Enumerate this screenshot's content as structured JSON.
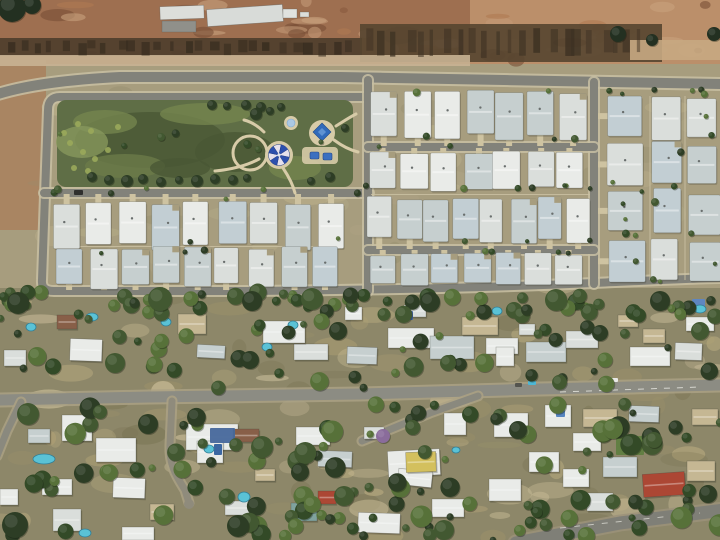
{
  "meta": {
    "label": "Aerial photograph of a new suburban housing estate with a park and playground beside cleared construction land, bordering an older tree-covered suburb"
  },
  "palette": {
    "dirt": "#a06f4e",
    "dirtR": "#bd8f68",
    "groundNew": "#a89d7c",
    "groundOld": "#8d8767",
    "road": "#82827a",
    "roadOld": "#8c8c83",
    "curbNew": "#c8bfa2",
    "curbOld": "#aba183",
    "drive": "#cfc39f",
    "path": "#d8cba6",
    "parkBase": "#5f6e44",
    "pd": "#4a5733",
    "pl": "#74844c",
    "shrub": "#9aa957",
    "rw": "#e9ebe8",
    "rl": "#dadedb",
    "rg": "#c6cfcf",
    "rb": "#c2ced3",
    "rt": "#c6b791",
    "rbr": "#8a5f46",
    "rr": "#b04632",
    "ry": "#d4c059",
    "rteal": "#7fa39e",
    "pool": "#56c3d8",
    "poolEdge": "#2e7f98",
    "umbBlue": "#2b50b2",
    "umbWhite": "#e6e1ec",
    "canopy": "#2e6abf",
    "canopyIn": "#5d92d6",
    "dome": "#aac8e6"
  },
  "bg": [
    [
      0,
      0,
      720,
      74,
      "dirt"
    ],
    [
      470,
      0,
      250,
      64,
      "dirtR"
    ],
    [
      0,
      64,
      720,
      236,
      "groundNew"
    ],
    [
      0,
      60,
      46,
      170,
      "#ab8560"
    ],
    [
      0,
      288,
      720,
      252,
      "groundOld"
    ]
  ],
  "construction": {
    "patches": {
      "seed": 7,
      "count": 55,
      "x0": 0,
      "x1": 720,
      "y0": 0,
      "y1": 60,
      "colors": [
        "#8a5a3c",
        "#c49a74",
        "#b07a50",
        "#7a4f34",
        "#c9a27c"
      ]
    },
    "rects": [
      [
        0,
        38,
        362,
        18,
        "#4e3d2b"
      ],
      [
        360,
        24,
        302,
        38,
        "#57452f"
      ],
      [
        0,
        55,
        470,
        11,
        "#c9b291"
      ],
      [
        630,
        40,
        90,
        20,
        "#c8a87f"
      ]
    ],
    "ticks": [
      {
        "seed": 11,
        "count": 26,
        "x0": 4,
        "x1": 356,
        "y": 40,
        "h": 14,
        "c": "#382c1e"
      },
      {
        "seed": 12,
        "count": 22,
        "x0": 364,
        "x1": 648,
        "y": 28,
        "h": 28,
        "c": "#3e3122"
      }
    ],
    "sheds": [
      [
        160,
        6,
        44,
        13,
        -2,
        "#dcdeda"
      ],
      [
        207,
        7,
        76,
        17,
        -4,
        "#d8dbd8"
      ],
      [
        283,
        9,
        14,
        9,
        0,
        "#e0e2df"
      ],
      [
        162,
        21,
        34,
        11,
        0,
        "#90908a"
      ],
      [
        300,
        12,
        9,
        5,
        0,
        "#dcdeda"
      ]
    ],
    "trees": [
      [
        12,
        8,
        14
      ],
      [
        32,
        5,
        9
      ],
      [
        618,
        34,
        8
      ],
      [
        652,
        40,
        6
      ],
      [
        714,
        34,
        7
      ]
    ]
  },
  "groundBands": [
    {
      "seed": 41,
      "x0": 0,
      "x1": 720,
      "y0": 300,
      "y1": 538,
      "count": 70,
      "colors": [
        "#b3a274",
        "#c0b080",
        "#7a7451",
        "#9c9168"
      ],
      "op": 0.55
    },
    {
      "seed": 42,
      "x0": 46,
      "x1": 716,
      "y0": 90,
      "y1": 288,
      "count": 45,
      "colors": [
        "#b3a986",
        "#97906e",
        "#c2b68d"
      ],
      "op": 0.5
    },
    {
      "seed": 43,
      "x0": 10,
      "x1": 710,
      "y0": 305,
      "y1": 530,
      "count": 26,
      "colors": [
        "#c6b893",
        "#cfc098"
      ],
      "op": 0.65
    }
  ],
  "roadsOld": [
    {
      "d": "M0,400 L150,397 L360,394 L540,389 L720,385",
      "w": 11,
      "c": "roadOld",
      "curb": "curbOld"
    },
    {
      "d": "M478,396 L430,413 L362,441",
      "w": 7,
      "c": "#8a897d",
      "curb": "curbOld"
    },
    {
      "d": "M172,401 L170,445 C169,466 177,477 185,490 L189,503",
      "w": 7,
      "c": "#8f8b7b",
      "curb": "curbOld"
    },
    {
      "d": "M21,402 L7,431 L-3,456",
      "w": 7,
      "c": "#8a897d",
      "curb": "curbOld"
    },
    {
      "d": "M516,543 L620,523 L724,510",
      "w": 13,
      "c": "#7f7f77",
      "curb": "#9b9279"
    }
  ],
  "roadsNew": [
    {
      "d": "M-2,94 Q40,81 120,77 L340,77 Q520,80 720,84",
      "w": 10,
      "c": "road",
      "curb": "curbNew"
    },
    {
      "d": "M368,97 L60,97 Q48,97 48,110 L42,280 Q41,291 54,291 L250,291 C380,290 500,287 594,283 C660,280 700,278 722,278",
      "w": 8,
      "c": "road",
      "curb": "curbNew"
    },
    {
      "d": "M44,193 L369,193",
      "w": 8,
      "c": "road",
      "curb": "curbNew"
    },
    {
      "d": "M368,80 L368,291",
      "w": 8,
      "c": "road",
      "curb": "curbNew"
    },
    {
      "d": "M594,82 L594,284",
      "w": 8,
      "c": "road",
      "curb": "curbNew"
    },
    {
      "d": "M368,147 L594,147",
      "w": 8,
      "c": "road",
      "curb": "curbNew"
    },
    {
      "d": "M368,250 L594,250",
      "w": 8,
      "c": "road",
      "curb": "curbNew"
    }
  ],
  "dashes": [
    {
      "d": "M560,392 L700,387",
      "c": "#e8e8e2",
      "w": 1,
      "da": "6 7"
    },
    {
      "d": "M560,528 L700,513",
      "c": "#d8d8d0",
      "w": 1,
      "da": "6 8"
    }
  ],
  "roadDots": [
    [
      189,
      504,
      5,
      "#8f8b7b"
    ]
  ],
  "fences": [
    {
      "d": "M54,246.5 L342,246.5"
    },
    {
      "d": "M371,194.5 L590,194.5"
    },
    {
      "d": "M650,96 L650,280"
    },
    {
      "d": "M685,96 L685,280"
    }
  ],
  "park": {
    "base": [
      57,
      100,
      296,
      87
    ],
    "patches": [
      [
        150,
        140,
        75,
        28,
        "pd"
      ],
      [
        235,
        152,
        40,
        20,
        "pd"
      ],
      [
        105,
        122,
        32,
        12,
        "pl"
      ],
      [
        205,
        114,
        45,
        11,
        "pl"
      ],
      [
        295,
        168,
        26,
        12,
        "pl"
      ],
      [
        125,
        166,
        40,
        12,
        "#6b7a47"
      ],
      [
        82,
        142,
        26,
        16,
        "#87975a"
      ],
      [
        180,
        168,
        30,
        10,
        "pd"
      ]
    ],
    "shrubs": [
      [
        78,
        124
      ],
      [
        91,
        131
      ],
      [
        70,
        143
      ],
      [
        83,
        152
      ],
      [
        95,
        159
      ],
      [
        74,
        168
      ],
      [
        88,
        171
      ],
      [
        118,
        127
      ],
      [
        108,
        150
      ],
      [
        64,
        133
      ]
    ],
    "trees": [
      [
        212,
        105,
        5
      ],
      [
        227,
        106,
        4
      ],
      [
        246,
        105,
        5
      ],
      [
        261,
        107,
        5
      ],
      [
        256,
        114,
        6
      ],
      [
        270,
        111,
        4
      ],
      [
        281,
        107,
        4
      ],
      [
        92,
        177,
        5
      ],
      [
        109,
        180,
        5
      ],
      [
        127,
        181,
        6
      ],
      [
        143,
        179,
        5
      ],
      [
        161,
        182,
        5
      ],
      [
        179,
        180,
        4
      ],
      [
        197,
        181,
        6
      ],
      [
        215,
        179,
        5
      ],
      [
        233,
        180,
        5
      ],
      [
        247,
        178,
        4
      ],
      [
        330,
        177,
        5
      ],
      [
        311,
        181,
        4
      ],
      [
        345,
        128,
        4
      ]
    ],
    "paths": [
      "M215,171 C235,169 248,165 259,159",
      "M283,168 C289,177 293,185 295,193",
      "M336,126 C344,121 350,117 356,114",
      "M334,140 C342,146 350,150 358,152",
      "M264,132 C258,126 252,122 244,120"
    ],
    "circlePath": [
      250,
      153,
      17
    ],
    "umbCircle": [
      279,
      155,
      14
    ],
    "smallCircle": [
      291,
      123,
      7
    ],
    "rightCircle": [
      322,
      133,
      13
    ],
    "miniPad": [
      302,
      147,
      36,
      17
    ],
    "miniCanopies": [
      [
        310,
        152,
        9,
        7
      ],
      [
        323,
        153,
        9,
        7
      ]
    ],
    "dome": [
      291,
      123,
      4
    ],
    "canopyCenter": [
      322,
      132
    ],
    "canopyR": 9,
    "umbR": 10.5
  },
  "blocks": [
    {
      "seed": 21,
      "x0": 371,
      "count": 7,
      "w": 27,
      "gap": 31.5,
      "y": 92,
      "h": 45,
      "drive": "down",
      "droad": 144
    },
    {
      "seed": 22,
      "x0": 369,
      "count": 7,
      "w": 27,
      "gap": 31.5,
      "y": 153,
      "h": 38,
      "drive": "up",
      "droad": 150
    },
    {
      "seed": 23,
      "x0": 369,
      "count": 8,
      "w": 24,
      "gap": 28,
      "y": 198,
      "h": 42,
      "drive": "down",
      "droad": 247
    },
    {
      "seed": 24,
      "x0": 371,
      "count": 7,
      "w": 26,
      "gap": 31,
      "y": 254,
      "h": 30,
      "drive": "up",
      "droad": 252
    },
    {
      "seed": 25,
      "x0": 53,
      "count": 9,
      "w": 26,
      "gap": 33,
      "y": 203,
      "h": 43,
      "drive": "up",
      "droad": 196
    },
    {
      "seed": 26,
      "x0": 56,
      "count": 9,
      "w": 26,
      "gap": 32,
      "y": 248,
      "h": 38,
      "drive": "down",
      "droad": 288
    },
    {
      "seed": 27,
      "x0": 608,
      "w": 36,
      "y0": 98,
      "rows": 4,
      "rgap": 47,
      "h": 42,
      "drive": "left",
      "droad": 598
    },
    {
      "seed": 28,
      "x0": 652,
      "w": 28,
      "y0": 96,
      "rows": 4,
      "rgap": 47,
      "h": 42
    },
    {
      "seed": 29,
      "x0": 688,
      "w": 30,
      "y0": 100,
      "rows": 4,
      "rgap": 47,
      "h": 40
    }
  ],
  "houseColors": [
    "rw",
    "rl",
    "rg",
    "rb"
  ],
  "oldHouses": [
    [
      4,
      350,
      22,
      16,
      "rl",
      0
    ],
    [
      57,
      315,
      20,
      14,
      "rbr",
      0
    ],
    [
      70,
      339,
      32,
      22,
      "rw",
      2
    ],
    [
      178,
      314,
      28,
      20,
      "rt",
      0
    ],
    [
      197,
      345,
      28,
      13,
      "rg",
      3
    ],
    [
      294,
      344,
      34,
      16,
      "rl",
      0
    ],
    [
      263,
      321,
      42,
      22,
      "rw",
      0
    ],
    [
      345,
      307,
      17,
      13,
      "rw",
      0
    ],
    [
      347,
      347,
      30,
      17,
      "rg",
      2
    ],
    [
      388,
      328,
      46,
      20,
      "rw",
      0
    ],
    [
      404,
      305,
      22,
      12,
      "rl",
      0
    ],
    [
      430,
      336,
      44,
      23,
      "rg",
      0
    ],
    [
      462,
      317,
      36,
      18,
      "rt",
      0
    ],
    [
      486,
      338,
      32,
      16,
      "rw",
      0
    ],
    [
      519,
      324,
      16,
      11,
      "rl",
      0
    ],
    [
      496,
      347,
      18,
      19,
      "rw",
      0
    ],
    [
      526,
      342,
      40,
      20,
      "rg",
      0
    ],
    [
      566,
      331,
      32,
      17,
      "rl",
      0
    ],
    [
      618,
      315,
      20,
      12,
      "rt",
      0
    ],
    [
      643,
      329,
      22,
      14,
      "rt",
      0
    ],
    [
      686,
      317,
      28,
      14,
      "rw",
      0
    ],
    [
      675,
      343,
      27,
      17,
      "rl",
      2
    ],
    [
      630,
      347,
      40,
      19,
      "rw",
      0
    ],
    [
      28,
      429,
      22,
      14,
      "rg",
      0
    ],
    [
      62,
      415,
      30,
      26,
      "rw",
      0
    ],
    [
      96,
      438,
      40,
      24,
      "rw",
      0
    ],
    [
      186,
      424,
      52,
      26,
      "rw",
      0
    ],
    [
      233,
      429,
      26,
      13,
      "rbr",
      0
    ],
    [
      296,
      427,
      34,
      18,
      "rw",
      0
    ],
    [
      318,
      451,
      34,
      16,
      "rg",
      2
    ],
    [
      364,
      427,
      20,
      12,
      "rl",
      0
    ],
    [
      388,
      450,
      52,
      26,
      "rw",
      -3
    ],
    [
      398,
      470,
      34,
      16,
      "rw",
      6
    ],
    [
      406,
      452,
      30,
      20,
      "ry",
      -2
    ],
    [
      318,
      491,
      18,
      13,
      "rr",
      0
    ],
    [
      291,
      503,
      26,
      18,
      "rteal",
      0
    ],
    [
      358,
      513,
      42,
      20,
      "rw",
      2
    ],
    [
      432,
      499,
      32,
      18,
      "rw",
      0
    ],
    [
      444,
      413,
      22,
      22,
      "rw",
      0
    ],
    [
      494,
      413,
      34,
      24,
      "rw",
      0
    ],
    [
      545,
      405,
      26,
      22,
      "rw",
      0
    ],
    [
      583,
      409,
      34,
      18,
      "rt",
      0
    ],
    [
      629,
      406,
      30,
      16,
      "rg",
      2
    ],
    [
      692,
      409,
      26,
      16,
      "rt",
      0
    ],
    [
      573,
      433,
      28,
      18,
      "rw",
      0
    ],
    [
      529,
      452,
      30,
      20,
      "rw",
      0
    ],
    [
      603,
      457,
      34,
      20,
      "rg",
      0
    ],
    [
      643,
      473,
      42,
      23,
      "rr",
      -4
    ],
    [
      687,
      461,
      28,
      20,
      "rt",
      0
    ],
    [
      563,
      469,
      26,
      18,
      "rw",
      0
    ],
    [
      489,
      479,
      32,
      22,
      "rw",
      0
    ],
    [
      587,
      493,
      26,
      18,
      "rl",
      0
    ],
    [
      42,
      479,
      30,
      16,
      "rw",
      0
    ],
    [
      113,
      478,
      32,
      20,
      "rw",
      2
    ],
    [
      53,
      509,
      28,
      22,
      "rl",
      0
    ],
    [
      122,
      527,
      32,
      13,
      "rw",
      0
    ],
    [
      150,
      504,
      24,
      16,
      "rt",
      0
    ],
    [
      225,
      501,
      26,
      14,
      "rl",
      0
    ],
    [
      0,
      489,
      18,
      16,
      "rw",
      0
    ],
    [
      197,
      441,
      26,
      22,
      "rw",
      0
    ],
    [
      255,
      469,
      20,
      12,
      "rt",
      0
    ]
  ],
  "specials": [
    [
      692,
      299,
      13,
      9,
      "#5b86c8"
    ],
    [
      398,
      311,
      15,
      9,
      "#3f66ad"
    ],
    [
      210,
      428,
      25,
      15,
      "#44689f"
    ],
    [
      616,
      436,
      28,
      19,
      "#5f7f3e"
    ],
    [
      214,
      444,
      8,
      11,
      "#2f5fa0"
    ],
    [
      556,
      410,
      9,
      7,
      "#4d7fc0"
    ]
  ],
  "pools": [
    [
      92,
      317,
      6,
      4
    ],
    [
      31,
      327,
      5,
      4
    ],
    [
      267,
      347,
      5,
      4
    ],
    [
      293,
      325,
      5,
      4
    ],
    [
      497,
      311,
      5,
      4
    ],
    [
      523,
      317,
      6,
      4
    ],
    [
      700,
      309,
      6,
      4
    ],
    [
      44,
      459,
      11,
      5
    ],
    [
      244,
      497,
      6,
      5
    ],
    [
      629,
      445,
      8,
      5
    ],
    [
      85,
      533,
      6,
      4
    ],
    [
      209,
      449,
      5,
      4
    ],
    [
      456,
      450,
      4,
      3
    ],
    [
      166,
      322,
      5,
      4
    ]
  ],
  "cars": [
    [
      528,
      381,
      8,
      4,
      "#49b8d8"
    ],
    [
      610,
      378,
      8,
      4,
      "#e9e9e7"
    ],
    [
      515,
      383,
      7,
      4,
      "#54544e"
    ],
    [
      74,
      190,
      9,
      5,
      "#2f2f2d"
    ]
  ],
  "treeColors": [
    "#2c3d24",
    "#41582f",
    "#567237",
    "#324a26"
  ],
  "treeBands": [
    {
      "seed": 31,
      "x0": 0,
      "x1": 720,
      "y0": 292,
      "y1": 316,
      "count": 62,
      "rmin": 4,
      "rmax": 9
    },
    {
      "seed": 32,
      "x0": 0,
      "x1": 720,
      "y0": 316,
      "y1": 388,
      "count": 48,
      "rmin": 3,
      "rmax": 10
    },
    {
      "seed": 33,
      "x0": 0,
      "x1": 720,
      "y0": 402,
      "y1": 540,
      "count": 115,
      "rmin": 3,
      "rmax": 11
    },
    {
      "seed": 34,
      "x0": 50,
      "x1": 592,
      "y0": 131,
      "y1": 150,
      "count": 12,
      "rmin": 2,
      "rmax": 4
    },
    {
      "seed": 35,
      "x0": 50,
      "x1": 592,
      "y0": 185,
      "y1": 200,
      "count": 14,
      "rmin": 2,
      "rmax": 4
    },
    {
      "seed": 36,
      "x0": 50,
      "x1": 592,
      "y0": 238,
      "y1": 254,
      "count": 12,
      "rmin": 2,
      "rmax": 4
    },
    {
      "seed": 37,
      "x0": 600,
      "x1": 716,
      "y0": 92,
      "y1": 282,
      "count": 16,
      "rmin": 2,
      "rmax": 4
    },
    {
      "seed": 38,
      "x0": 380,
      "x1": 716,
      "y0": 87,
      "y1": 95,
      "count": 8,
      "rmin": 2,
      "rmax": 4
    }
  ],
  "topTrees": [
    [
      18,
      303,
      11,
      0
    ],
    [
      160,
      299,
      12,
      1
    ],
    [
      252,
      301,
      10,
      0
    ],
    [
      312,
      299,
      11,
      1
    ],
    [
      430,
      302,
      10,
      0
    ],
    [
      556,
      300,
      11,
      1
    ],
    [
      660,
      301,
      10,
      0
    ],
    [
      700,
      331,
      9,
      1
    ],
    [
      338,
      331,
      9,
      0
    ],
    [
      115,
      363,
      10,
      1
    ],
    [
      250,
      360,
      9,
      0
    ],
    [
      448,
      363,
      8,
      1
    ],
    [
      600,
      333,
      8,
      0
    ],
    [
      28,
      414,
      11,
      1
    ],
    [
      148,
      424,
      10,
      0
    ],
    [
      262,
      447,
      11,
      1
    ],
    [
      300,
      472,
      9,
      0
    ],
    [
      344,
      496,
      10,
      1
    ],
    [
      238,
      526,
      11,
      0
    ],
    [
      444,
      530,
      10,
      1
    ],
    [
      518,
      430,
      9,
      0
    ],
    [
      654,
      440,
      8,
      1
    ],
    [
      708,
      494,
      9,
      0
    ],
    [
      15,
      525,
      13,
      0
    ],
    [
      100,
      412,
      7,
      1
    ]
  ],
  "purpleTree": [
    383,
    436,
    7,
    "#8b6b9d"
  ]
}
